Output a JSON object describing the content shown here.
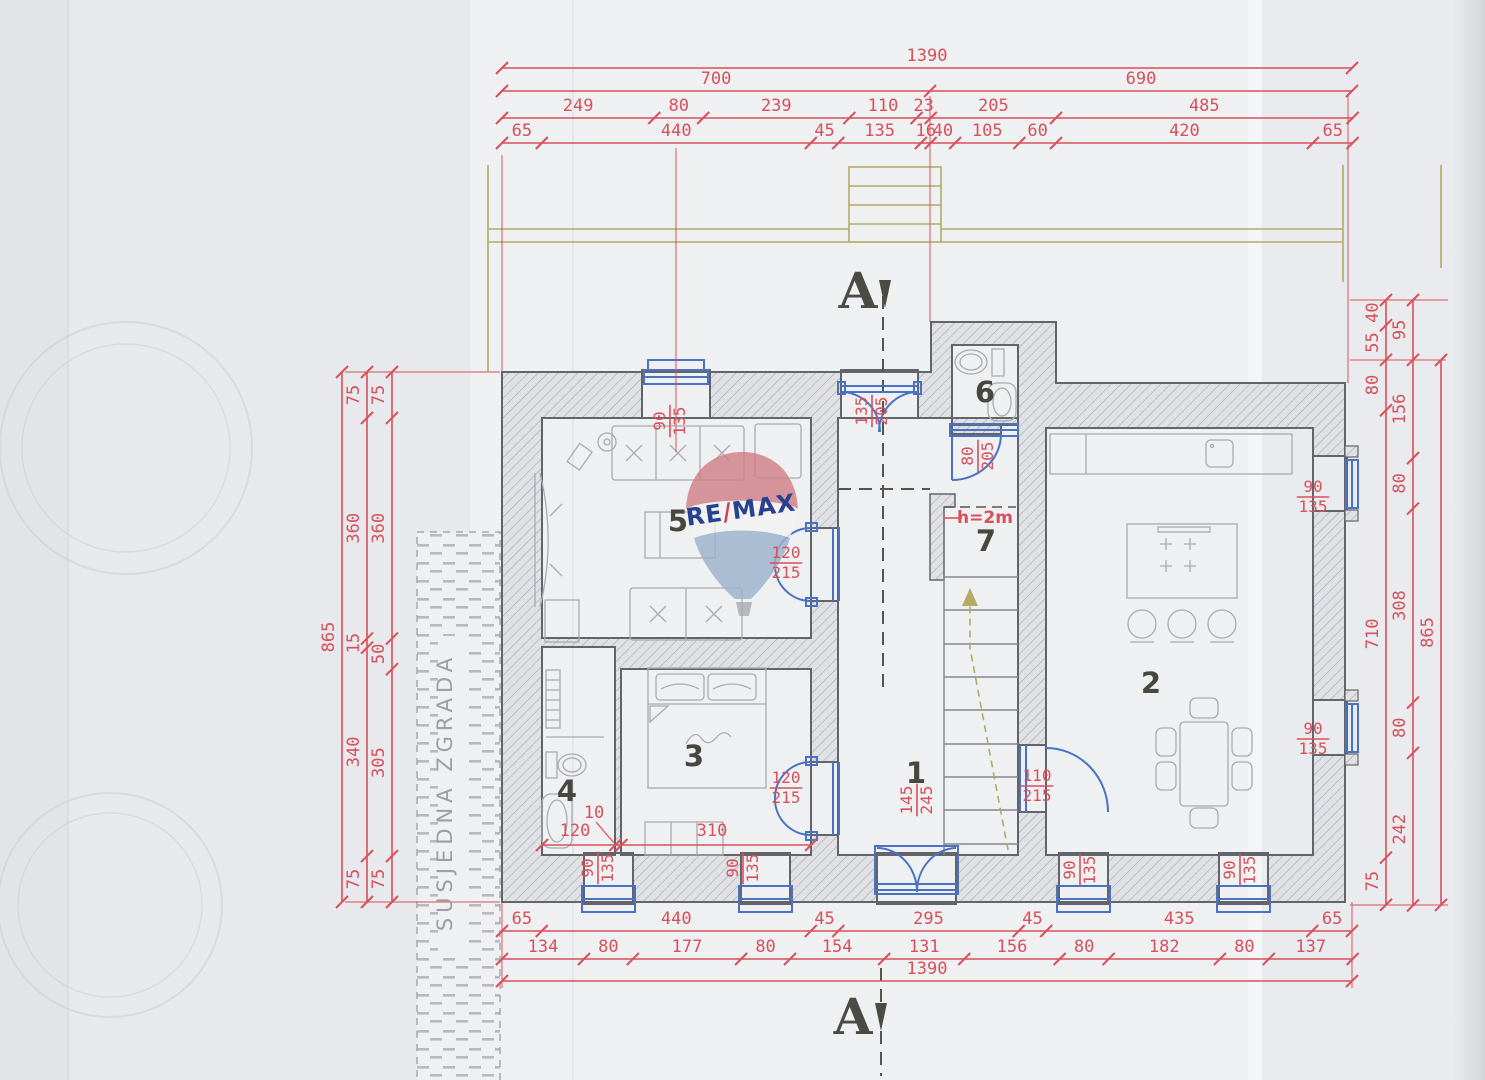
{
  "colors": {
    "paper": "#e7e9ec",
    "paper_bright": "#eff0f2",
    "dim_red": "#d8505a",
    "door_blue": "#4a72c4",
    "wall_stroke": "#63646a",
    "wall_fill": "#dfe1e5",
    "hatch_line": "#9fa3ab",
    "furniture": "#a8abb0",
    "olive": "#b3aa66",
    "room_label": "#48473f",
    "section_dark": "#55544e",
    "neighbor_grey": "#9aa0a6",
    "logo_blue": "#27408f",
    "logo_slash_red": "#c8454d",
    "balloon_red": "#cf8086",
    "balloon_blue": "#9db2cc",
    "stamp": "#c6cedb"
  },
  "logo": {
    "re": "RE",
    "slash": "/",
    "max": "MAX"
  },
  "plan": {
    "section_marker": "A",
    "neighbor_label": "SUSJEDNA ZGRADA",
    "height_note": "h=2m",
    "dim_chains": [
      {
        "id": "top-total",
        "o": [
          502,
          68
        ],
        "dir": "h",
        "s": 0.6115,
        "v": [
          1390
        ],
        "toff": -7
      },
      {
        "id": "top-700-690",
        "o": [
          502,
          91
        ],
        "dir": "h",
        "s": 0.6115,
        "v": [
          700,
          690
        ],
        "toff": -7
      },
      {
        "id": "top-sub",
        "o": [
          502,
          118
        ],
        "dir": "h",
        "s": 0.6115,
        "v": [
          249,
          80,
          239,
          110,
          23,
          205,
          485
        ],
        "toff": -7
      },
      {
        "id": "top-detail",
        "o": [
          502,
          143
        ],
        "dir": "h",
        "s": 0.6115,
        "v": [
          65,
          440,
          45,
          135,
          16,
          40,
          105,
          60,
          420,
          65
        ],
        "toff": -7
      },
      {
        "id": "bottom-1",
        "o": [
          502,
          931
        ],
        "dir": "h",
        "s": 0.6115,
        "v": [
          65,
          440,
          45,
          295,
          45,
          435,
          65
        ],
        "toff": -7
      },
      {
        "id": "bottom-2",
        "o": [
          502,
          959
        ],
        "dir": "h",
        "s": 0.6115,
        "v": [
          134,
          80,
          177,
          80,
          154,
          131,
          156,
          80,
          182,
          80,
          137
        ],
        "toff": -7
      },
      {
        "id": "bottom-total",
        "o": [
          502,
          981
        ],
        "dir": "h",
        "s": 0.6115,
        "v": [
          1390
        ],
        "toff": -7
      },
      {
        "id": "left-total",
        "o": [
          342,
          372
        ],
        "dir": "v",
        "s": 0.6127,
        "v": [
          865
        ],
        "toff": -8
      },
      {
        "id": "left-mid",
        "o": [
          367,
          372
        ],
        "dir": "v",
        "s": 0.6127,
        "v": [
          75,
          360,
          15,
          340,
          75
        ],
        "toff": -8
      },
      {
        "id": "left-inner",
        "o": [
          392,
          372
        ],
        "dir": "v",
        "s": 0.6127,
        "v": [
          75,
          360,
          50,
          305,
          75
        ],
        "toff": -8
      },
      {
        "id": "right-inner",
        "o": [
          1386,
          300
        ],
        "dir": "v",
        "s": 0.63,
        "v": [
          40,
          55,
          80,
          710,
          75
        ],
        "toff": -8
      },
      {
        "id": "right-mid",
        "o": [
          1413,
          300
        ],
        "dir": "v",
        "s": 0.63,
        "v": [
          95,
          156,
          80,
          308,
          80,
          242
        ],
        "toff": -8
      },
      {
        "id": "right-total",
        "o": [
          1441,
          360
        ],
        "dir": "v",
        "s": 0.63,
        "v": [
          865
        ],
        "toff": -8
      },
      {
        "id": "room34-interior",
        "o": [
          542,
          845
        ],
        "dir": "h",
        "s": 0.6115,
        "v": [
          120,
          10,
          310
        ],
        "toff": -7,
        "skip": [
          0,
          1,
          2
        ]
      }
    ],
    "fraction_labels": [
      {
        "a": "90",
        "b": "135",
        "x": 670,
        "y": 421,
        "rot": -90
      },
      {
        "a": "135",
        "b": "205",
        "x": 872,
        "y": 411,
        "rot": -90
      },
      {
        "a": "80",
        "b": "205",
        "x": 978,
        "y": 456,
        "rot": -90
      },
      {
        "a": "120",
        "b": "215",
        "x": 786,
        "y": 563,
        "rot": 0
      },
      {
        "a": "120",
        "b": "215",
        "x": 786,
        "y": 788,
        "rot": 0
      },
      {
        "a": "110",
        "b": "215",
        "x": 1037,
        "y": 786,
        "rot": 0
      },
      {
        "a": "145",
        "b": "245",
        "x": 917,
        "y": 800,
        "rot": -90
      },
      {
        "a": "90",
        "b": "135",
        "x": 598,
        "y": 868,
        "rot": -90
      },
      {
        "a": "90",
        "b": "135",
        "x": 743,
        "y": 868,
        "rot": -90
      },
      {
        "a": "90",
        "b": "135",
        "x": 1080,
        "y": 870,
        "rot": -90
      },
      {
        "a": "90",
        "b": "135",
        "x": 1240,
        "y": 870,
        "rot": -90
      },
      {
        "a": "90",
        "b": "135",
        "x": 1313,
        "y": 497,
        "rot": 0
      },
      {
        "a": "90",
        "b": "135",
        "x": 1313,
        "y": 739,
        "rot": 0
      }
    ],
    "free_labels": [
      {
        "t": "5",
        "x": 678,
        "y": 531,
        "cls": "room",
        "name": "room-label-5"
      },
      {
        "t": "3",
        "x": 694,
        "y": 766,
        "cls": "room",
        "name": "room-label-3"
      },
      {
        "t": "4",
        "x": 567,
        "y": 801,
        "cls": "room",
        "name": "room-label-4"
      },
      {
        "t": "1",
        "x": 916,
        "y": 783,
        "cls": "room",
        "name": "room-label-1"
      },
      {
        "t": "6",
        "x": 985,
        "y": 402,
        "cls": "room",
        "name": "room-label-6"
      },
      {
        "t": "7",
        "x": 986,
        "y": 551,
        "cls": "room",
        "name": "room-label-7"
      },
      {
        "t": "2",
        "x": 1151,
        "y": 693,
        "cls": "room",
        "name": "room-label-2"
      },
      {
        "t": "h=2m",
        "x": 985,
        "y": 523,
        "cls": "note",
        "name": "height-note"
      },
      {
        "t": "A",
        "x": 858,
        "y": 308,
        "cls": "section",
        "name": "section-marker-top"
      },
      {
        "t": "A",
        "x": 853,
        "y": 1034,
        "cls": "section",
        "name": "section-marker-bottom"
      },
      {
        "t": "SUSJEDNA ZGRADA",
        "x": 452,
        "y": 792,
        "cls": "neighbor",
        "rot": -90,
        "name": "neighbor-building-label"
      },
      {
        "t": "120",
        "x": 575,
        "y": 836,
        "cls": "dim",
        "name": "interior-dim-120"
      },
      {
        "t": "10",
        "x": 594,
        "y": 818,
        "cls": "dim",
        "name": "interior-dim-10"
      },
      {
        "t": "310",
        "x": 712,
        "y": 836,
        "cls": "dim",
        "name": "interior-dim-310"
      }
    ]
  }
}
